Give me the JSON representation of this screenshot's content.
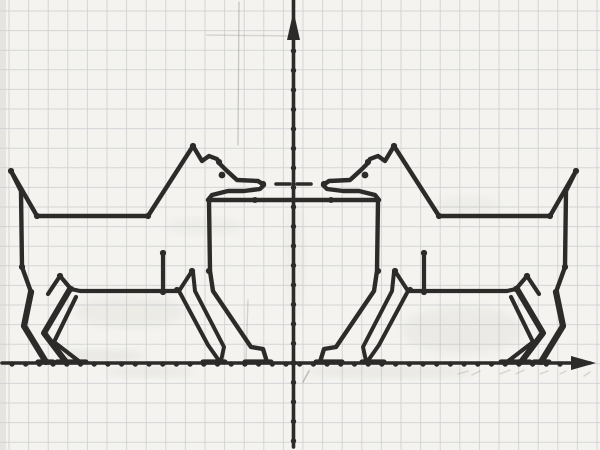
{
  "canvas": {
    "width": 600,
    "height": 450,
    "paper_color": "#f4f3ef",
    "grid_color": "#cbced1",
    "ink_color": "#2c2b29",
    "pencil_color": "#a9a8a2",
    "grid_spacing": 19.6,
    "grid_offset_x": 9,
    "grid_offset_y": 11
  },
  "axes": {
    "x_axis": {
      "y": 363,
      "x_start": 2,
      "x_end": 590,
      "arrow_tip_x": 596,
      "arrow_base_x": 571,
      "arrow_half_h": 7,
      "tick_start": 12,
      "tick_end": 568,
      "tick_step": 13.7,
      "tick_r": 2.7
    },
    "y_axis": {
      "x": 293.5,
      "y_start": 0,
      "y_end": 447,
      "arrow_tip_y": 11,
      "arrow_base_y": 40,
      "arrow_half_w": 6.5,
      "tick_start": 51,
      "tick_end": 445,
      "tick_step": 19.5,
      "tick_r": 2.7
    },
    "origin_dot": {
      "x": 293.5,
      "y": 363,
      "r": 3
    }
  },
  "figure": {
    "mirror_axis_x": 587,
    "stroke_width_default": 4.4,
    "shared": {
      "rect_top": [
        [
          208,
          200
        ],
        [
          379,
          200
        ]
      ],
      "junction_dots": [
        [
          255,
          200
        ],
        [
          331,
          200
        ]
      ]
    },
    "dog": {
      "paths": [
        {
          "name": "head-and-back-outline",
          "w": 4.4,
          "pts": [
            [
              11,
              171
            ],
            [
              37,
              216
            ],
            [
              148,
              216
            ],
            [
              193,
              146
            ],
            [
              202,
              161
            ],
            [
              209,
              156
            ],
            [
              217,
              159
            ],
            [
              220,
              164
            ],
            [
              226,
              170
            ],
            [
              237,
              180
            ],
            [
              258,
              181
            ],
            [
              264,
              185
            ],
            [
              260,
              189
            ],
            [
              244,
              191
            ],
            [
              228,
              191
            ],
            [
              212,
              195
            ],
            [
              208,
              200
            ]
          ]
        },
        {
          "name": "chest-and-front-leg-outer",
          "w": 4.4,
          "pts": [
            [
              209,
              201
            ],
            [
              210,
              271
            ],
            [
              213,
              291
            ],
            [
              251,
              347
            ],
            [
              263,
              349
            ],
            [
              267,
              362
            ]
          ]
        },
        {
          "name": "front-leg-inner-a",
          "w": 4.0,
          "pts": [
            [
              192,
              271
            ],
            [
              179,
              291
            ],
            [
              208,
              345
            ],
            [
              220,
              362
            ]
          ]
        },
        {
          "name": "front-leg-inner-b",
          "w": 4.0,
          "pts": [
            [
              193,
              272
            ],
            [
              195,
              291
            ],
            [
              224,
              347
            ],
            [
              221,
              361
            ]
          ]
        },
        {
          "name": "tail-and-rump",
          "w": 4.4,
          "pts": [
            [
              11,
              171
            ],
            [
              21,
              191
            ],
            [
              22,
              267
            ],
            [
              31,
              292
            ]
          ]
        },
        {
          "name": "hind-leg-chevron-a",
          "w": 6.2,
          "pts": [
            [
              31,
              292
            ],
            [
              24,
              326
            ],
            [
              46,
              362
            ]
          ]
        },
        {
          "name": "hind-leg-chevron-b",
          "w": 6.0,
          "pts": [
            [
              70,
              289
            ],
            [
              44,
              333
            ],
            [
              66,
              362
            ]
          ]
        },
        {
          "name": "hind-leg-chevron-c",
          "w": 4.2,
          "pts": [
            [
              76,
              297
            ],
            [
              54,
              342
            ],
            [
              80,
              362
            ]
          ]
        },
        {
          "name": "hip-joint",
          "w": 4.2,
          "pts": [
            [
              48,
              294
            ],
            [
              60,
              276
            ],
            [
              71,
              289
            ]
          ]
        },
        {
          "name": "belly-line",
          "w": 4.2,
          "pts": [
            [
              71,
              289
            ],
            [
              80,
              291
            ],
            [
              177,
              291
            ]
          ]
        },
        {
          "name": "belly-stub",
          "w": 4.2,
          "pts": [
            [
              163,
              253
            ],
            [
              163,
              292
            ]
          ]
        },
        {
          "name": "front-foot-dash-1",
          "w": 5.2,
          "pts": [
            [
              203,
              362
            ],
            [
              225,
              362
            ]
          ]
        },
        {
          "name": "front-foot-dash-2",
          "w": 5.2,
          "pts": [
            [
              245,
              362
            ],
            [
              271,
              362
            ]
          ]
        },
        {
          "name": "hind-foot-dash-1",
          "w": 5.2,
          "pts": [
            [
              38,
              362
            ],
            [
              53,
              362
            ]
          ]
        },
        {
          "name": "hind-foot-dash-2",
          "w": 5.2,
          "pts": [
            [
              57,
              362
            ],
            [
              71,
              362
            ]
          ]
        },
        {
          "name": "hind-foot-dash-3",
          "w": 5.2,
          "pts": [
            [
              72,
              362
            ],
            [
              86,
              362
            ]
          ]
        },
        {
          "name": "nose-dash",
          "w": 3.6,
          "pts": [
            [
              276,
              184
            ],
            [
              290,
              184
            ]
          ]
        }
      ],
      "vertex_dots": [
        [
          11,
          171
        ],
        [
          37,
          216
        ],
        [
          148,
          216
        ],
        [
          193,
          146
        ],
        [
          219,
          162
        ],
        [
          263,
          184
        ],
        [
          60,
          276
        ],
        [
          163,
          253
        ],
        [
          163,
          292
        ],
        [
          177,
          290
        ],
        [
          192,
          271
        ],
        [
          209,
          271
        ],
        [
          22,
          267
        ],
        [
          71,
          289
        ],
        [
          31,
          292
        ]
      ],
      "vertex_dot_r": 3.1,
      "eye": {
        "cx": 222,
        "cy": 175,
        "r": 3.4
      }
    }
  },
  "pencil_marks": {
    "lines": [
      {
        "pts": [
          [
            239,
            2
          ],
          [
            238,
            145
          ]
        ],
        "w": 1.3,
        "o": 0.45
      },
      {
        "pts": [
          [
            207,
            35
          ],
          [
            291,
            36
          ]
        ],
        "w": 1.5,
        "o": 0.3
      },
      {
        "pts": [
          [
            248,
            300
          ],
          [
            246,
            360
          ]
        ],
        "w": 1.3,
        "o": 0.35
      },
      {
        "pts": [
          [
            303,
            382
          ],
          [
            309,
            371
          ]
        ],
        "w": 1.6,
        "o": 0.5
      },
      {
        "pts": [
          [
            458,
            374
          ],
          [
            468,
            371
          ]
        ],
        "w": 1.4,
        "o": 0.3
      },
      {
        "pts": [
          [
            472,
            375
          ],
          [
            480,
            371
          ]
        ],
        "w": 1.4,
        "o": 0.3
      },
      {
        "pts": [
          [
            500,
            374
          ],
          [
            510,
            370
          ]
        ],
        "w": 1.4,
        "o": 0.3
      },
      {
        "pts": [
          [
            516,
            374
          ],
          [
            524,
            370
          ]
        ],
        "w": 1.4,
        "o": 0.3
      },
      {
        "pts": [
          [
            540,
            374
          ],
          [
            548,
            371
          ]
        ],
        "w": 1.4,
        "o": 0.3
      },
      {
        "pts": [
          [
            560,
            374
          ],
          [
            566,
            371
          ]
        ],
        "w": 1.4,
        "o": 0.3
      },
      {
        "pts": [
          [
            584,
            376
          ],
          [
            590,
            372
          ]
        ],
        "w": 1.4,
        "o": 0.3
      }
    ],
    "blobs": [
      {
        "cx": 130,
        "cy": 312,
        "rx": 55,
        "ry": 16,
        "o": 0.1
      },
      {
        "cx": 462,
        "cy": 330,
        "rx": 60,
        "ry": 24,
        "o": 0.11
      },
      {
        "cx": 390,
        "cy": 372,
        "rx": 85,
        "ry": 7,
        "o": 0.13
      },
      {
        "cx": 205,
        "cy": 226,
        "rx": 38,
        "ry": 9,
        "o": 0.08
      },
      {
        "cx": 468,
        "cy": 205,
        "rx": 32,
        "ry": 9,
        "o": 0.08
      },
      {
        "cx": 100,
        "cy": 356,
        "rx": 45,
        "ry": 7,
        "o": 0.13
      },
      {
        "cx": 150,
        "cy": 372,
        "rx": 45,
        "ry": 6,
        "o": 0.12
      },
      {
        "cx": 295,
        "cy": 260,
        "rx": 10,
        "ry": 55,
        "o": 0.07
      }
    ]
  }
}
